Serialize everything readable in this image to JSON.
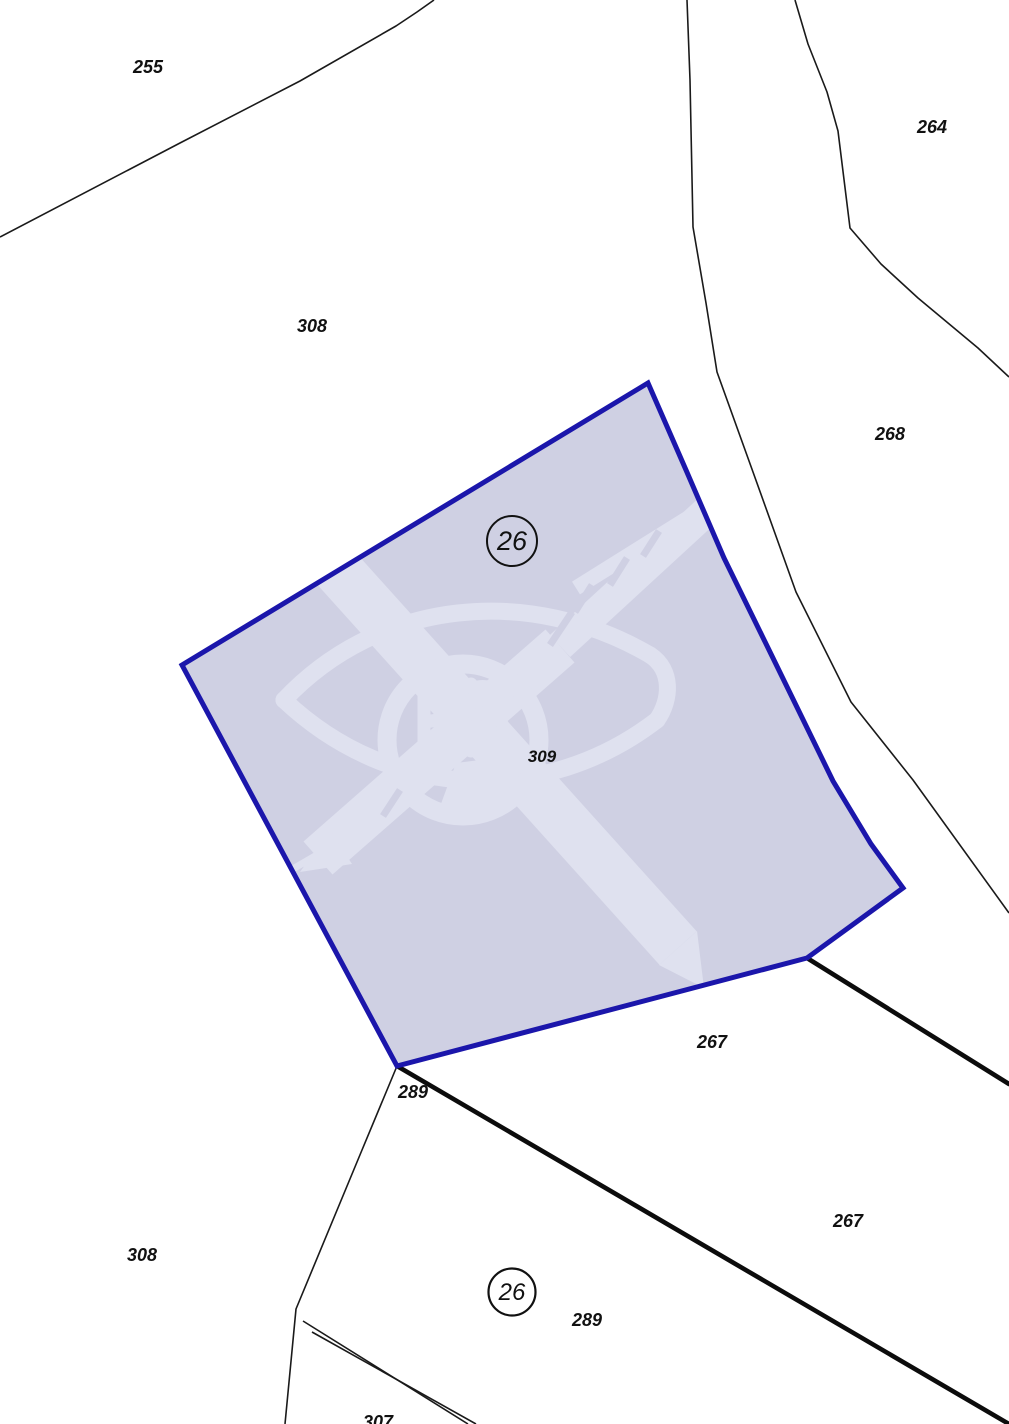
{
  "app": {
    "title": "Cadastral map extract"
  },
  "map": {
    "width": 1009,
    "height": 1424,
    "background": "#ffffff",
    "colors": {
      "thin_line": "#1a1a1a",
      "thick_line": "#0c0c0c",
      "parcel_fill": "#cfd0e3",
      "parcel_stroke": "#1b16ab",
      "watermark": "#dfe1ef",
      "label_text": "#111111"
    },
    "selected_parcel": {
      "id": "309",
      "points": "648,383 686,470 724,558 771,654 833,781 871,844 903,888 807,958 397,1066 182,665",
      "stroke_width": 5
    },
    "boundaries": {
      "thin": [
        {
          "name": "boundary-255-308",
          "points": "0,237 180,143 300,81 396,26 417,12 434,0"
        },
        {
          "name": "boundary-corridor-west-268",
          "points": "687,0 690,80 693,227 706,303 717,372 753,472 796,592 851,702 913,780 1009,913"
        },
        {
          "name": "boundary-corridor-east-264",
          "points": "795,0 808,44 827,92 838,131 850,228 881,264 918,298 978,348 1009,377"
        },
        {
          "name": "boundary-308-289",
          "points": "397,1066 362,1150 296,1309 285,1424"
        },
        {
          "name": "boundary-289-307-upper",
          "points": "303,1321 468,1424"
        },
        {
          "name": "boundary-289-307-lower",
          "points": "312,1332 476,1424"
        }
      ],
      "thick": [
        {
          "name": "boundary-289-267",
          "points": "397,1066 1009,1424"
        },
        {
          "name": "boundary-267-north",
          "points": "807,958 1009,1084"
        }
      ]
    },
    "labels": [
      {
        "text": "255",
        "x": 148,
        "y": 73,
        "size": 18
      },
      {
        "text": "264",
        "x": 932,
        "y": 133,
        "size": 18
      },
      {
        "text": "308",
        "x": 312,
        "y": 332,
        "size": 18
      },
      {
        "text": "268",
        "x": 890,
        "y": 440,
        "size": 18
      },
      {
        "text": "309",
        "x": 542,
        "y": 762,
        "size": 17
      },
      {
        "text": "267",
        "x": 712,
        "y": 1048,
        "size": 18
      },
      {
        "text": "289",
        "x": 413,
        "y": 1098,
        "size": 18
      },
      {
        "text": "267",
        "x": 848,
        "y": 1227,
        "size": 18
      },
      {
        "text": "308",
        "x": 142,
        "y": 1261,
        "size": 18
      },
      {
        "text": "289",
        "x": 587,
        "y": 1326,
        "size": 18
      },
      {
        "text": "307",
        "x": 378,
        "y": 1428,
        "size": 18
      }
    ],
    "circles": [
      {
        "text": "26",
        "cx": 512,
        "cy": 541,
        "r": 25,
        "font": 27,
        "stroke_width": 2
      },
      {
        "text": "26",
        "cx": 512,
        "cy": 1292,
        "r": 23.5,
        "font": 24,
        "stroke_width": 2.2
      }
    ]
  }
}
